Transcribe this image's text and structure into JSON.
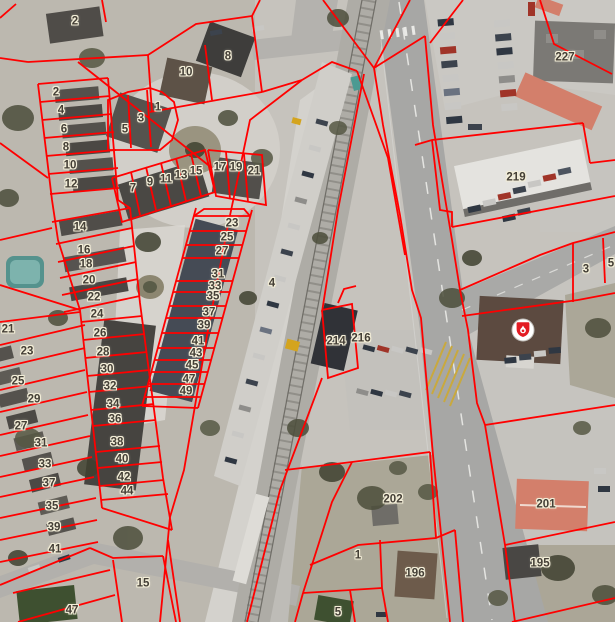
{
  "map": {
    "line_color": "#ff0000",
    "label_text_color": "#443f36",
    "label_halo_color": "#f3eed8",
    "marker": {
      "icon": "fire-station-shield",
      "x": 523,
      "y": 330,
      "shield_color": "#e31b23",
      "ring_color": "#ffffff"
    },
    "labels": [
      {
        "text": "2",
        "x": 75,
        "y": 22
      },
      {
        "text": "8",
        "x": 228,
        "y": 57
      },
      {
        "text": "10",
        "x": 186,
        "y": 73
      },
      {
        "text": "2",
        "x": 56,
        "y": 93
      },
      {
        "text": "4",
        "x": 61,
        "y": 111
      },
      {
        "text": "6",
        "x": 64,
        "y": 130
      },
      {
        "text": "8",
        "x": 66,
        "y": 148
      },
      {
        "text": "10",
        "x": 70,
        "y": 166
      },
      {
        "text": "12",
        "x": 71,
        "y": 185
      },
      {
        "text": "1",
        "x": 158,
        "y": 108
      },
      {
        "text": "3",
        "x": 141,
        "y": 119
      },
      {
        "text": "5",
        "x": 125,
        "y": 130
      },
      {
        "text": "7",
        "x": 133,
        "y": 189
      },
      {
        "text": "9",
        "x": 150,
        "y": 183
      },
      {
        "text": "11",
        "x": 166,
        "y": 180
      },
      {
        "text": "13",
        "x": 181,
        "y": 176
      },
      {
        "text": "15",
        "x": 196,
        "y": 172
      },
      {
        "text": "17",
        "x": 220,
        "y": 168
      },
      {
        "text": "19",
        "x": 236,
        "y": 168
      },
      {
        "text": "21",
        "x": 254,
        "y": 172
      },
      {
        "text": "14",
        "x": 80,
        "y": 228
      },
      {
        "text": "16",
        "x": 84,
        "y": 251
      },
      {
        "text": "18",
        "x": 86,
        "y": 265
      },
      {
        "text": "20",
        "x": 89,
        "y": 281
      },
      {
        "text": "22",
        "x": 94,
        "y": 298
      },
      {
        "text": "24",
        "x": 97,
        "y": 315
      },
      {
        "text": "26",
        "x": 100,
        "y": 334
      },
      {
        "text": "28",
        "x": 103,
        "y": 353
      },
      {
        "text": "30",
        "x": 107,
        "y": 370
      },
      {
        "text": "32",
        "x": 110,
        "y": 387
      },
      {
        "text": "34",
        "x": 113,
        "y": 405
      },
      {
        "text": "36",
        "x": 115,
        "y": 420
      },
      {
        "text": "38",
        "x": 117,
        "y": 443
      },
      {
        "text": "40",
        "x": 122,
        "y": 460
      },
      {
        "text": "42",
        "x": 124,
        "y": 478
      },
      {
        "text": "44",
        "x": 127,
        "y": 492
      },
      {
        "text": "23",
        "x": 232,
        "y": 224
      },
      {
        "text": "25",
        "x": 227,
        "y": 238
      },
      {
        "text": "27",
        "x": 222,
        "y": 252
      },
      {
        "text": "31",
        "x": 218,
        "y": 275
      },
      {
        "text": "33",
        "x": 215,
        "y": 287
      },
      {
        "text": "35",
        "x": 213,
        "y": 297
      },
      {
        "text": "37",
        "x": 209,
        "y": 313
      },
      {
        "text": "39",
        "x": 204,
        "y": 326
      },
      {
        "text": "41",
        "x": 198,
        "y": 342
      },
      {
        "text": "43",
        "x": 196,
        "y": 354
      },
      {
        "text": "45",
        "x": 192,
        "y": 366
      },
      {
        "text": "47",
        "x": 189,
        "y": 380
      },
      {
        "text": "49",
        "x": 186,
        "y": 392
      },
      {
        "text": "4",
        "x": 272,
        "y": 284
      },
      {
        "text": "21",
        "x": 8,
        "y": 330
      },
      {
        "text": "23",
        "x": 27,
        "y": 352
      },
      {
        "text": "25",
        "x": 18,
        "y": 382
      },
      {
        "text": "29",
        "x": 34,
        "y": 400
      },
      {
        "text": "27",
        "x": 21,
        "y": 427
      },
      {
        "text": "31",
        "x": 41,
        "y": 444
      },
      {
        "text": "33",
        "x": 45,
        "y": 465
      },
      {
        "text": "37",
        "x": 49,
        "y": 484
      },
      {
        "text": "35",
        "x": 52,
        "y": 507
      },
      {
        "text": "39",
        "x": 54,
        "y": 528
      },
      {
        "text": "41",
        "x": 55,
        "y": 550
      },
      {
        "text": "47",
        "x": 72,
        "y": 611
      },
      {
        "text": "15",
        "x": 143,
        "y": 584
      },
      {
        "text": "214",
        "x": 336,
        "y": 342
      },
      {
        "text": "216",
        "x": 361,
        "y": 339
      },
      {
        "text": "202",
        "x": 393,
        "y": 500
      },
      {
        "text": "1",
        "x": 358,
        "y": 556
      },
      {
        "text": "196",
        "x": 415,
        "y": 574
      },
      {
        "text": "5",
        "x": 338,
        "y": 613
      },
      {
        "text": "201",
        "x": 546,
        "y": 505
      },
      {
        "text": "195",
        "x": 540,
        "y": 564
      },
      {
        "text": "227",
        "x": 565,
        "y": 58
      },
      {
        "text": "219",
        "x": 516,
        "y": 178
      },
      {
        "text": "3",
        "x": 586,
        "y": 270
      },
      {
        "text": "5",
        "x": 611,
        "y": 264
      }
    ],
    "parcel_lines": [
      "410,0 374,68 383,125 400,215 412,290 421,318 433,455 450,622",
      "323,0 374,68",
      "374,68 425,36",
      "425,36 433,125 442,180 452,240 460,290",
      "460,290 468,330 477,403 485,425 505,545 515,622",
      "460,290 540,255 573,243 615,232",
      "430,43 463,0",
      "540,0 554,44 612,74",
      "415,145 432,140 583,123",
      "583,123 590,163",
      "590,163 615,160",
      "432,140 440,210 452,212 452,227",
      "452,227 615,196",
      "573,243 573,302",
      "603,238 605,283",
      "578,300 615,293",
      "462,316 578,300",
      "485,425 615,405",
      "505,545 615,522",
      "512,622 615,598",
      "302,80 250,120 228,225 208,330 184,470 170,517 160,622",
      "302,80 332,62 357,71",
      "357,71 388,158 405,255",
      "364,74 338,210 322,312",
      "322,310 352,304 358,368 328,378 322,310",
      "338,303 344,289 356,286",
      "322,378 280,490 247,622",
      "168,540 180,622",
      "285,470 352,462 430,452",
      "430,452 436,538",
      "310,565 358,545 436,538 455,530",
      "352,462 332,502 303,593",
      "380,540 382,588",
      "303,593 382,588",
      "455,530 463,622",
      "382,588 388,622",
      "350,590 355,622",
      "303,593 295,622",
      "0,585 90,548",
      "90,548 113,558 163,556",
      "113,560 122,622",
      "163,556 176,622",
      "13,593 110,570",
      "18,622 115,595",
      "0,18 16,4",
      "102,0 106,22",
      "0,58 28,62",
      "28,62 148,55",
      "78,62 212,168",
      "38,84 108,78",
      "38,84 52,200 58,240 80,310 102,508",
      "108,78 118,200 130,208 140,303 163,478",
      "40,102 110,96",
      "42,120 112,114",
      "44,138 114,132",
      "46,156 116,150",
      "48,174 118,168",
      "50,194 119,188",
      "0,143 48,178",
      "0,240 52,228",
      "0,285 80,310",
      "0,322 80,312",
      "52,222 130,208",
      "56,244 132,228",
      "58,262 134,246",
      "60,278 136,262",
      "62,295 138,279",
      "64,312 140,296",
      "108,150 108,100 128,92 150,88 162,92 174,102 178,120 172,140 160,150 108,150",
      "128,95 131,148",
      "147,90 151,147",
      "112,178 205,150 215,192 122,222 112,178",
      "131,172 140,215",
      "146,167 156,210",
      "161,163 171,206",
      "176,158 186,201",
      "191,154 201,196",
      "208,150 262,155 266,205 216,196 208,150",
      "226,152 230,199",
      "244,154 248,202",
      "148,55 196,24 252,16",
      "252,16 262,92",
      "150,112 262,92",
      "148,55 152,112",
      "205,45 212,100",
      "262,92 302,80",
      "252,16 260,0",
      "196,208 142,406",
      "252,210 198,408",
      "142,406 198,408",
      "194,216 204,209 244,209 250,216",
      "194,216 250,216",
      "190,231 246,231",
      "186,245 242,245",
      "182,258 239,258",
      "176,281 233,281",
      "173,292 230,292",
      "169,306 226,306",
      "166,318 222,318",
      "162,333 218,333",
      "158,348 214,348",
      "155,360 211,360",
      "151,372 208,372",
      "148,384 204,384",
      "144,397 201,397",
      "81,322 142,316",
      "83,340 145,334",
      "85,358 147,352",
      "87,376 150,370",
      "89,392 152,386",
      "91,410 154,404",
      "93,426 156,420",
      "96,452 160,446",
      "98,468 162,462",
      "100,486 164,480",
      "101,500 168,494",
      "163,478 172,530",
      "102,508 172,530",
      "0,345 85,325",
      "0,368 85,348",
      "0,390 85,370",
      "0,412 87,392",
      "0,435 88,415",
      "0,456 90,436",
      "0,477 92,457",
      "0,497 94,477",
      "0,518 96,498",
      "0,540 97,520",
      "0,562 98,542"
    ]
  }
}
